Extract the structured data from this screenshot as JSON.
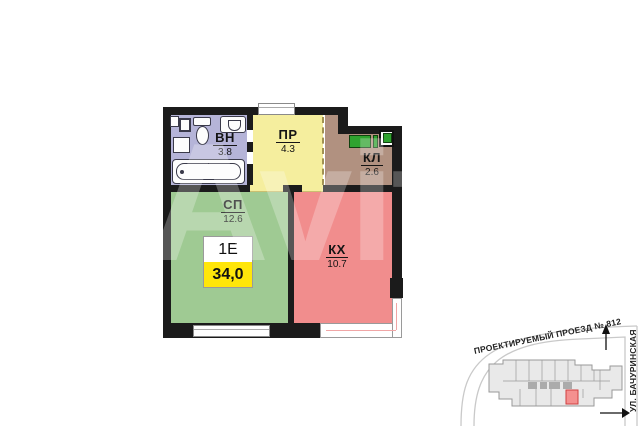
{
  "floor_plan": {
    "unit_type": "1Е",
    "total_area": "34,0",
    "rooms": {
      "vn": {
        "code": "ВН",
        "area": "3.8"
      },
      "pr": {
        "code": "ПР",
        "area": "4.3"
      },
      "kl": {
        "code": "КЛ",
        "area": "2.6"
      },
      "sp": {
        "code": "СП",
        "area": "12.6"
      },
      "kx": {
        "code": "КХ",
        "area": "10.7"
      }
    },
    "colors": {
      "bathroom": "#b5b4d8",
      "hallway": "#f5ee9e",
      "closet": "#b19180",
      "bedroom": "#9fca93",
      "kitchen": "#f18d8d",
      "area_highlight": "#ffe60a",
      "wardrobe_green": "#2fa32f",
      "walls": "#1b1b1b",
      "map_unit_red": "#f4908f"
    }
  },
  "watermark": "Avito",
  "minimap": {
    "street_top": "ПРОЕКТИРУЕМЫЙ ПРОЕЗД № 812",
    "street_right": "УЛ. БАЧУРИНСКАЯ"
  }
}
